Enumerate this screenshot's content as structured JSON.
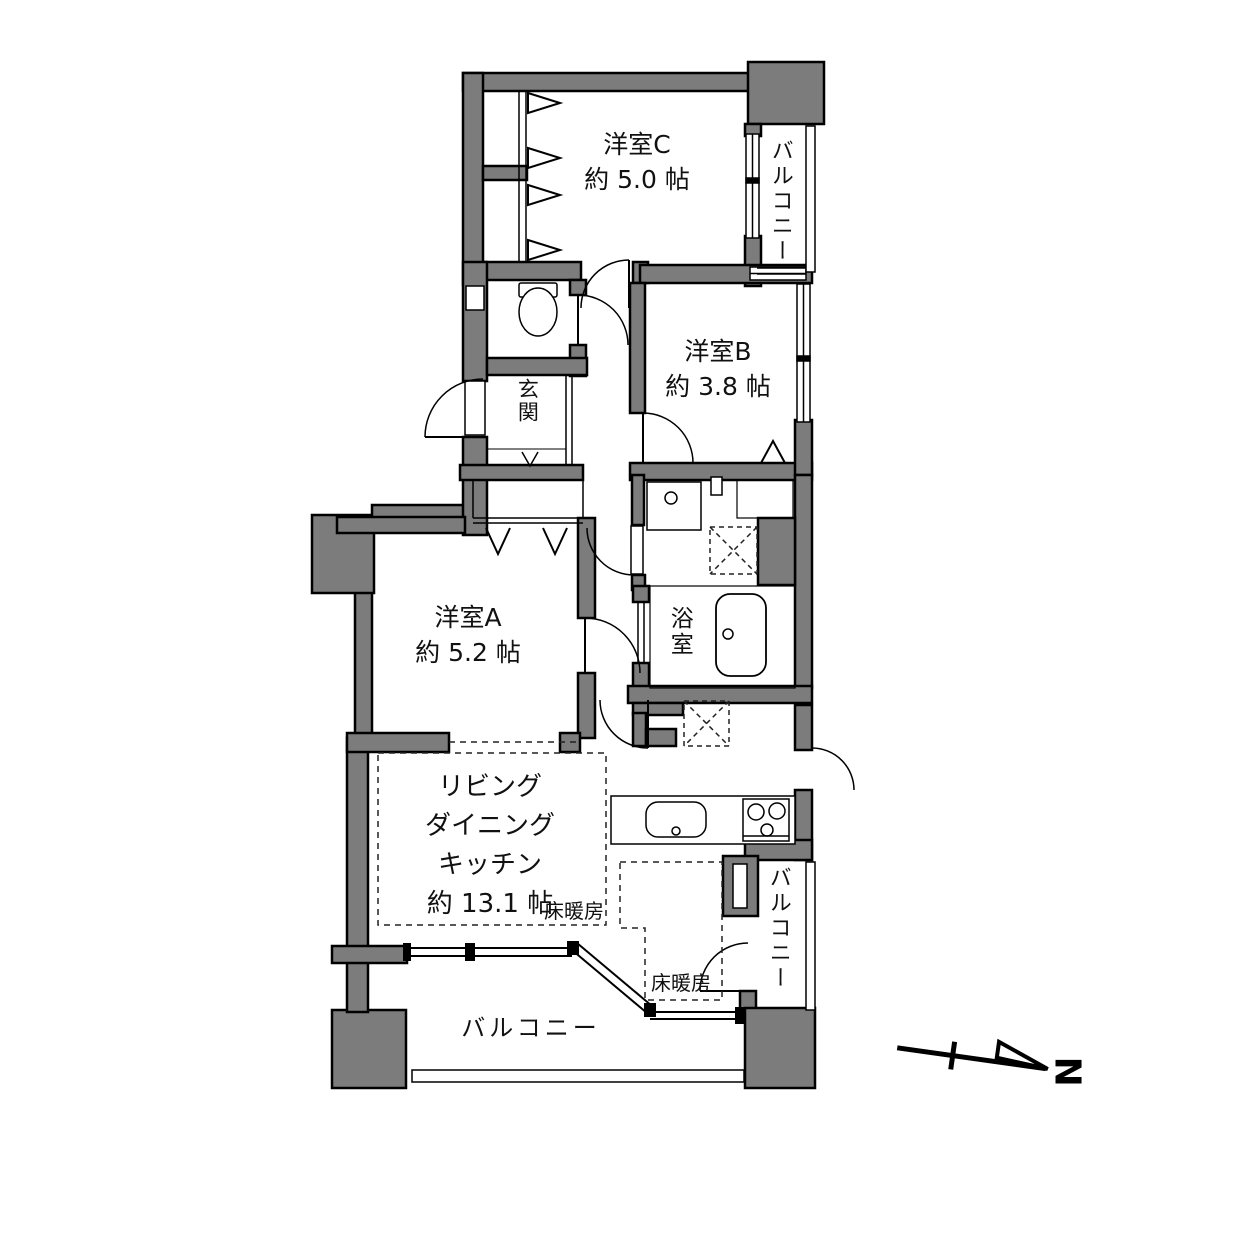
{
  "plan": {
    "rooms": {
      "western_c": {
        "name": "洋室C",
        "size": "約 5.0 帖"
      },
      "western_b": {
        "name": "洋室B",
        "size": "約 3.8 帖"
      },
      "western_a": {
        "name": "洋室A",
        "size": "約 5.2 帖"
      },
      "ldk": {
        "name": "リビング\nダイニング\nキッチン",
        "size": "約 13.1 帖"
      },
      "entrance": {
        "name": "玄関"
      },
      "bathroom": {
        "name": "浴室"
      }
    },
    "balconies": {
      "top": "バルコニー",
      "right": "バルコニー",
      "bottom": "バルコニー"
    },
    "floor_heating": {
      "living": "床暖房",
      "dining": "床暖房"
    },
    "compass": {
      "label": "N"
    },
    "colors": {
      "wall_fill": "#7c7c7c",
      "line": "#000000",
      "background": "#ffffff"
    }
  }
}
